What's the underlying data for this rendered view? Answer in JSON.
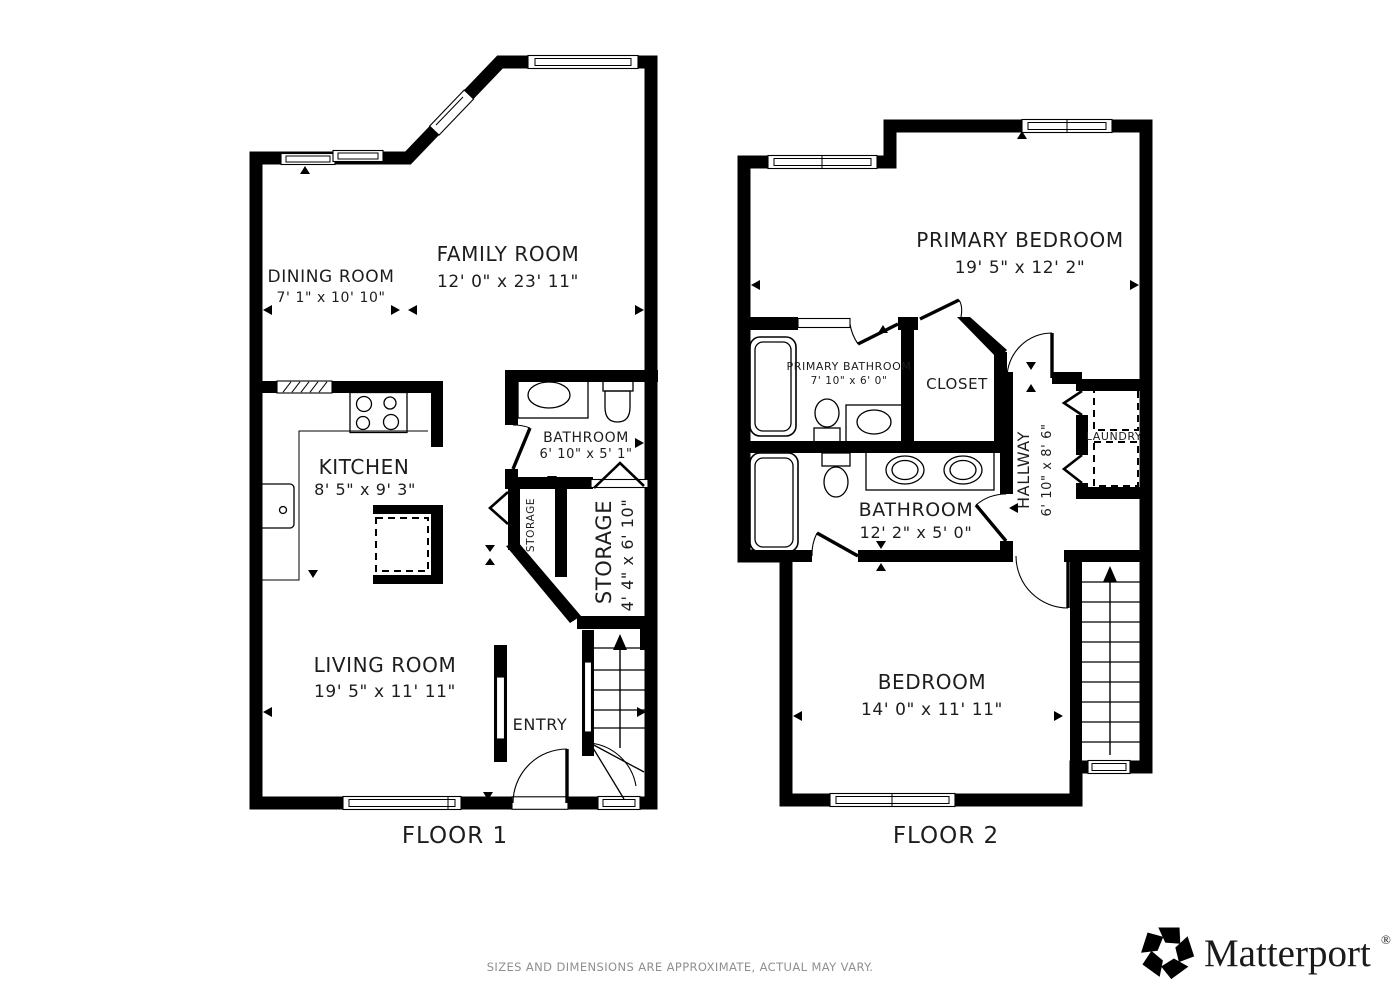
{
  "floor1": {
    "label": "FLOOR 1",
    "rooms": {
      "dining": {
        "name": "DINING ROOM",
        "dims": "7' 1\" x 10' 10\""
      },
      "family": {
        "name": "FAMILY ROOM",
        "dims": "12' 0\" x 23' 11\""
      },
      "kitchen": {
        "name": "KITCHEN",
        "dims": "8' 5\" x 9' 3\""
      },
      "bathroom": {
        "name": "BATHROOM",
        "dims": "6' 10\" x 5' 1\""
      },
      "closet": {
        "name": "STORAGE"
      },
      "storage": {
        "name": "STORAGE",
        "dims": "4' 4\" x 6' 10\""
      },
      "living": {
        "name": "LIVING ROOM",
        "dims": "19' 5\" x 11' 11\""
      },
      "entry": {
        "name": "ENTRY"
      }
    }
  },
  "floor2": {
    "label": "FLOOR 2",
    "rooms": {
      "primary_bedroom": {
        "name": "PRIMARY BEDROOM",
        "dims": "19' 5\" x 12' 2\""
      },
      "primary_bathroom": {
        "name": "PRIMARY BATHROOM",
        "dims": "7' 10\" x 6' 0\""
      },
      "closet": {
        "name": "CLOSET"
      },
      "hallway": {
        "name": "HALLWAY",
        "dims": "6' 10\" x 8' 6\""
      },
      "laundry": {
        "name": "LAUNDRY"
      },
      "bathroom": {
        "name": "BATHROOM",
        "dims": "12' 2\" x 5' 0\""
      },
      "bedroom": {
        "name": "BEDROOM",
        "dims": "14' 0\" x 11' 11\""
      }
    }
  },
  "footer": {
    "disclaimer": "SIZES AND DIMENSIONS ARE APPROXIMATE, ACTUAL MAY VARY."
  },
  "branding": {
    "name": "Matterport",
    "registered": "®"
  },
  "colors": {
    "wall": "#000000",
    "text": "#1d1d1d",
    "muted": "#8f8f8f",
    "background": "#ffffff"
  }
}
